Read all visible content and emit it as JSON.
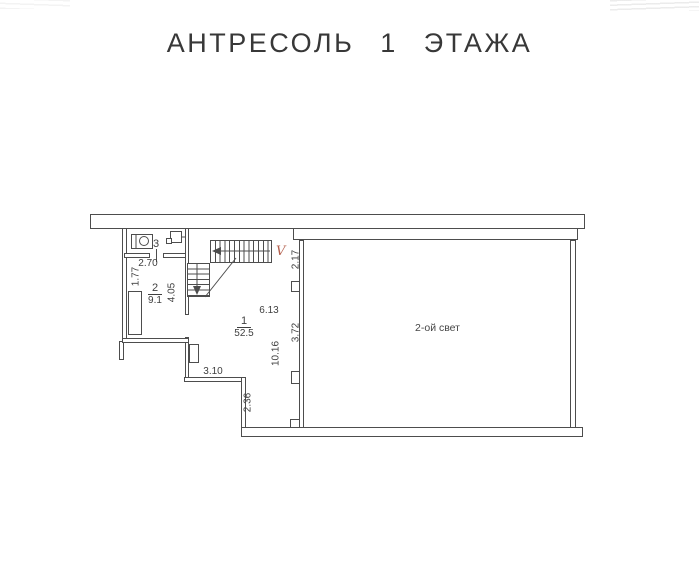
{
  "title": "АНТРЕСОЛЬ 1 ЭТАЖА",
  "rooms": {
    "room1": {
      "number": "1",
      "area": "52.5"
    },
    "room2": {
      "number": "2",
      "area": "9.1"
    },
    "room3": {
      "number": "3"
    },
    "void": {
      "label": "2-ой свет"
    }
  },
  "dimensions": {
    "w270": "2.70",
    "h177": "1.77",
    "h405": "4.05",
    "h217": "2.17",
    "w613": "6.13",
    "h372": "3.72",
    "h1016": "10.16",
    "w310": "3.10",
    "h236": "2.36"
  },
  "marks": {
    "stair_v": "V"
  },
  "icons": {
    "toilet": "wc-toilet-icon",
    "panel": "electrical-panel-icon",
    "stairs": "staircase-icon",
    "arrows": "stair-direction-arrow-icon"
  },
  "colors": {
    "ink": "#4d4d4d",
    "stair_mark": "#b4604e",
    "paper": "#ffffff"
  }
}
